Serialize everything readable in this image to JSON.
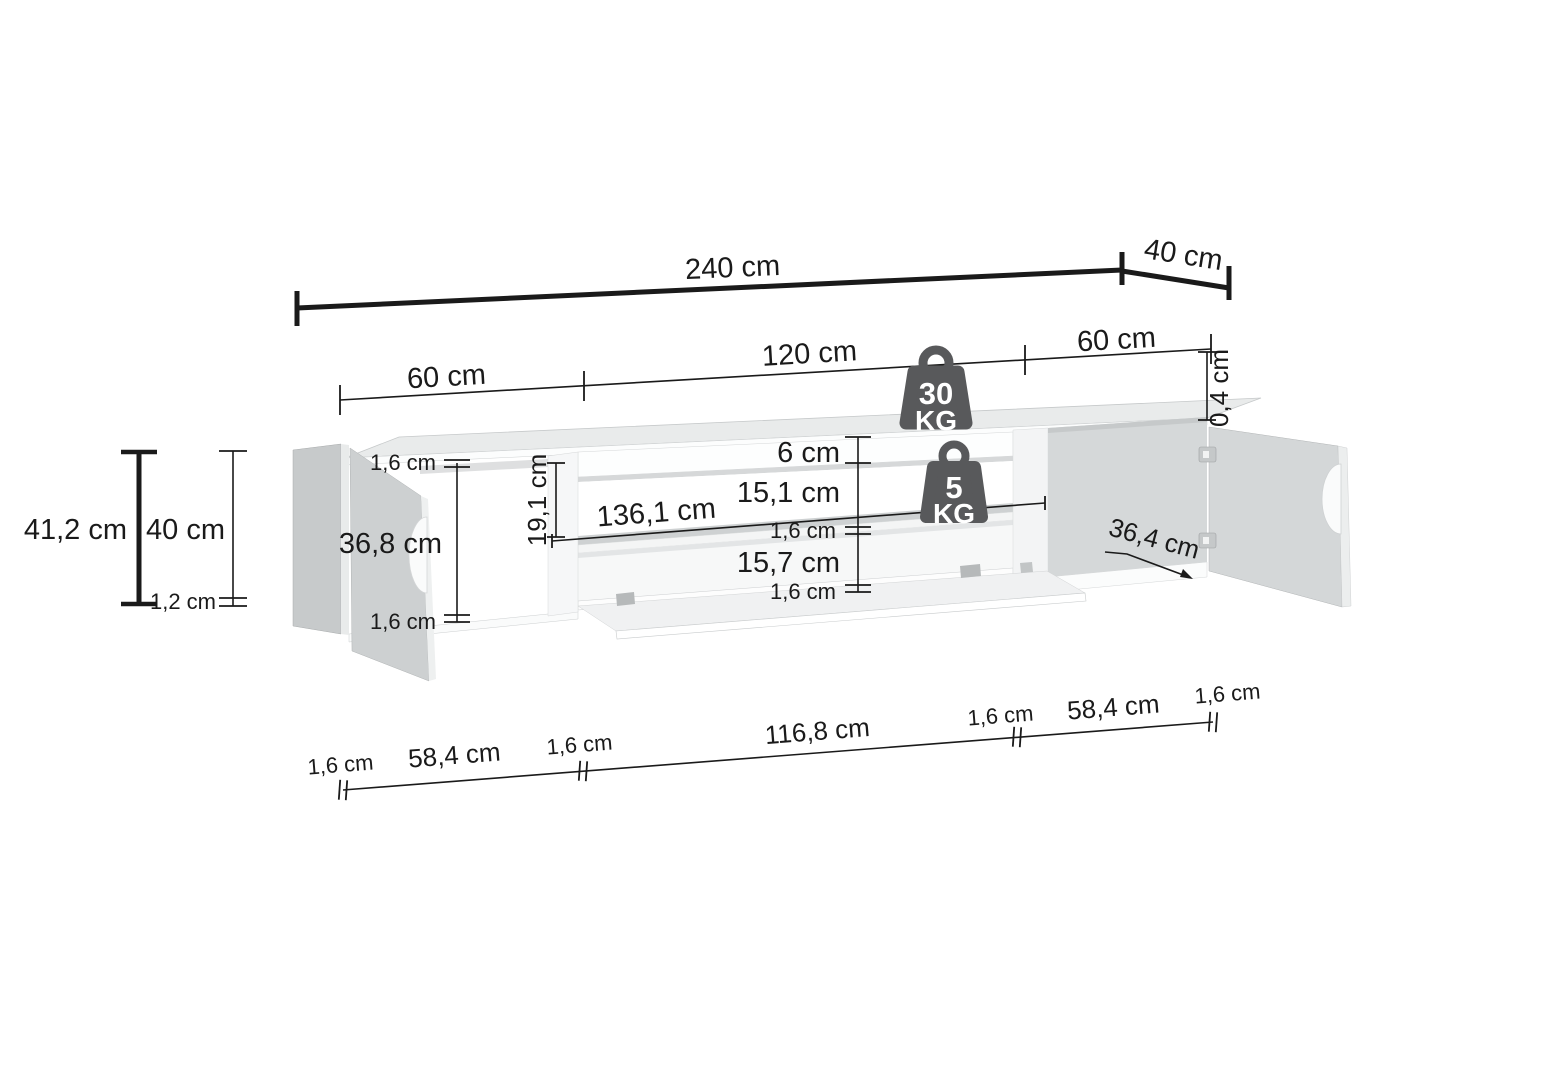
{
  "diagram": {
    "type": "furniture-dimension-drawing",
    "subject": "wall-mounted TV stand with two doors and drop-down flap",
    "background_color": "#ffffff",
    "line_color": "#1a1a1a",
    "furniture_body_color": "#cdd0d1",
    "furniture_light_color": "#f6f7f7",
    "icon_color": "#58595b",
    "unit": "cm"
  },
  "dimensions": {
    "overall_width": "240 cm",
    "overall_depth": "40 cm",
    "front_spans": [
      "60 cm",
      "120 cm",
      "60 cm"
    ],
    "top_panel_thickness": "0,4 cm",
    "overall_height": "41,2 cm",
    "carcass_height": "40 cm",
    "base_gap": "1,2 cm",
    "left_panel_top": "1,6 cm",
    "left_opening_height": "36,8 cm",
    "left_panel_bottom": "1,6 cm",
    "niche_rear_height": "19,1 cm",
    "shelf_length": "136,1 cm",
    "top_rail_height": "6 cm",
    "upper_niche_height": "15,1 cm",
    "shelf_thickness": "1,6 cm",
    "lower_niche_height": "15,7 cm",
    "bottom_panel_thickness": "1,6 cm",
    "interior_depth": "36,4 cm",
    "bottom_spans": [
      "1,6 cm",
      "58,4 cm",
      "1,6 cm",
      "116,8 cm",
      "1,6 cm",
      "58,4 cm",
      "1,6 cm"
    ]
  },
  "load_limits": {
    "top": {
      "value": "30",
      "unit": "KG"
    },
    "shelf": {
      "value": "5",
      "unit": "KG"
    }
  }
}
